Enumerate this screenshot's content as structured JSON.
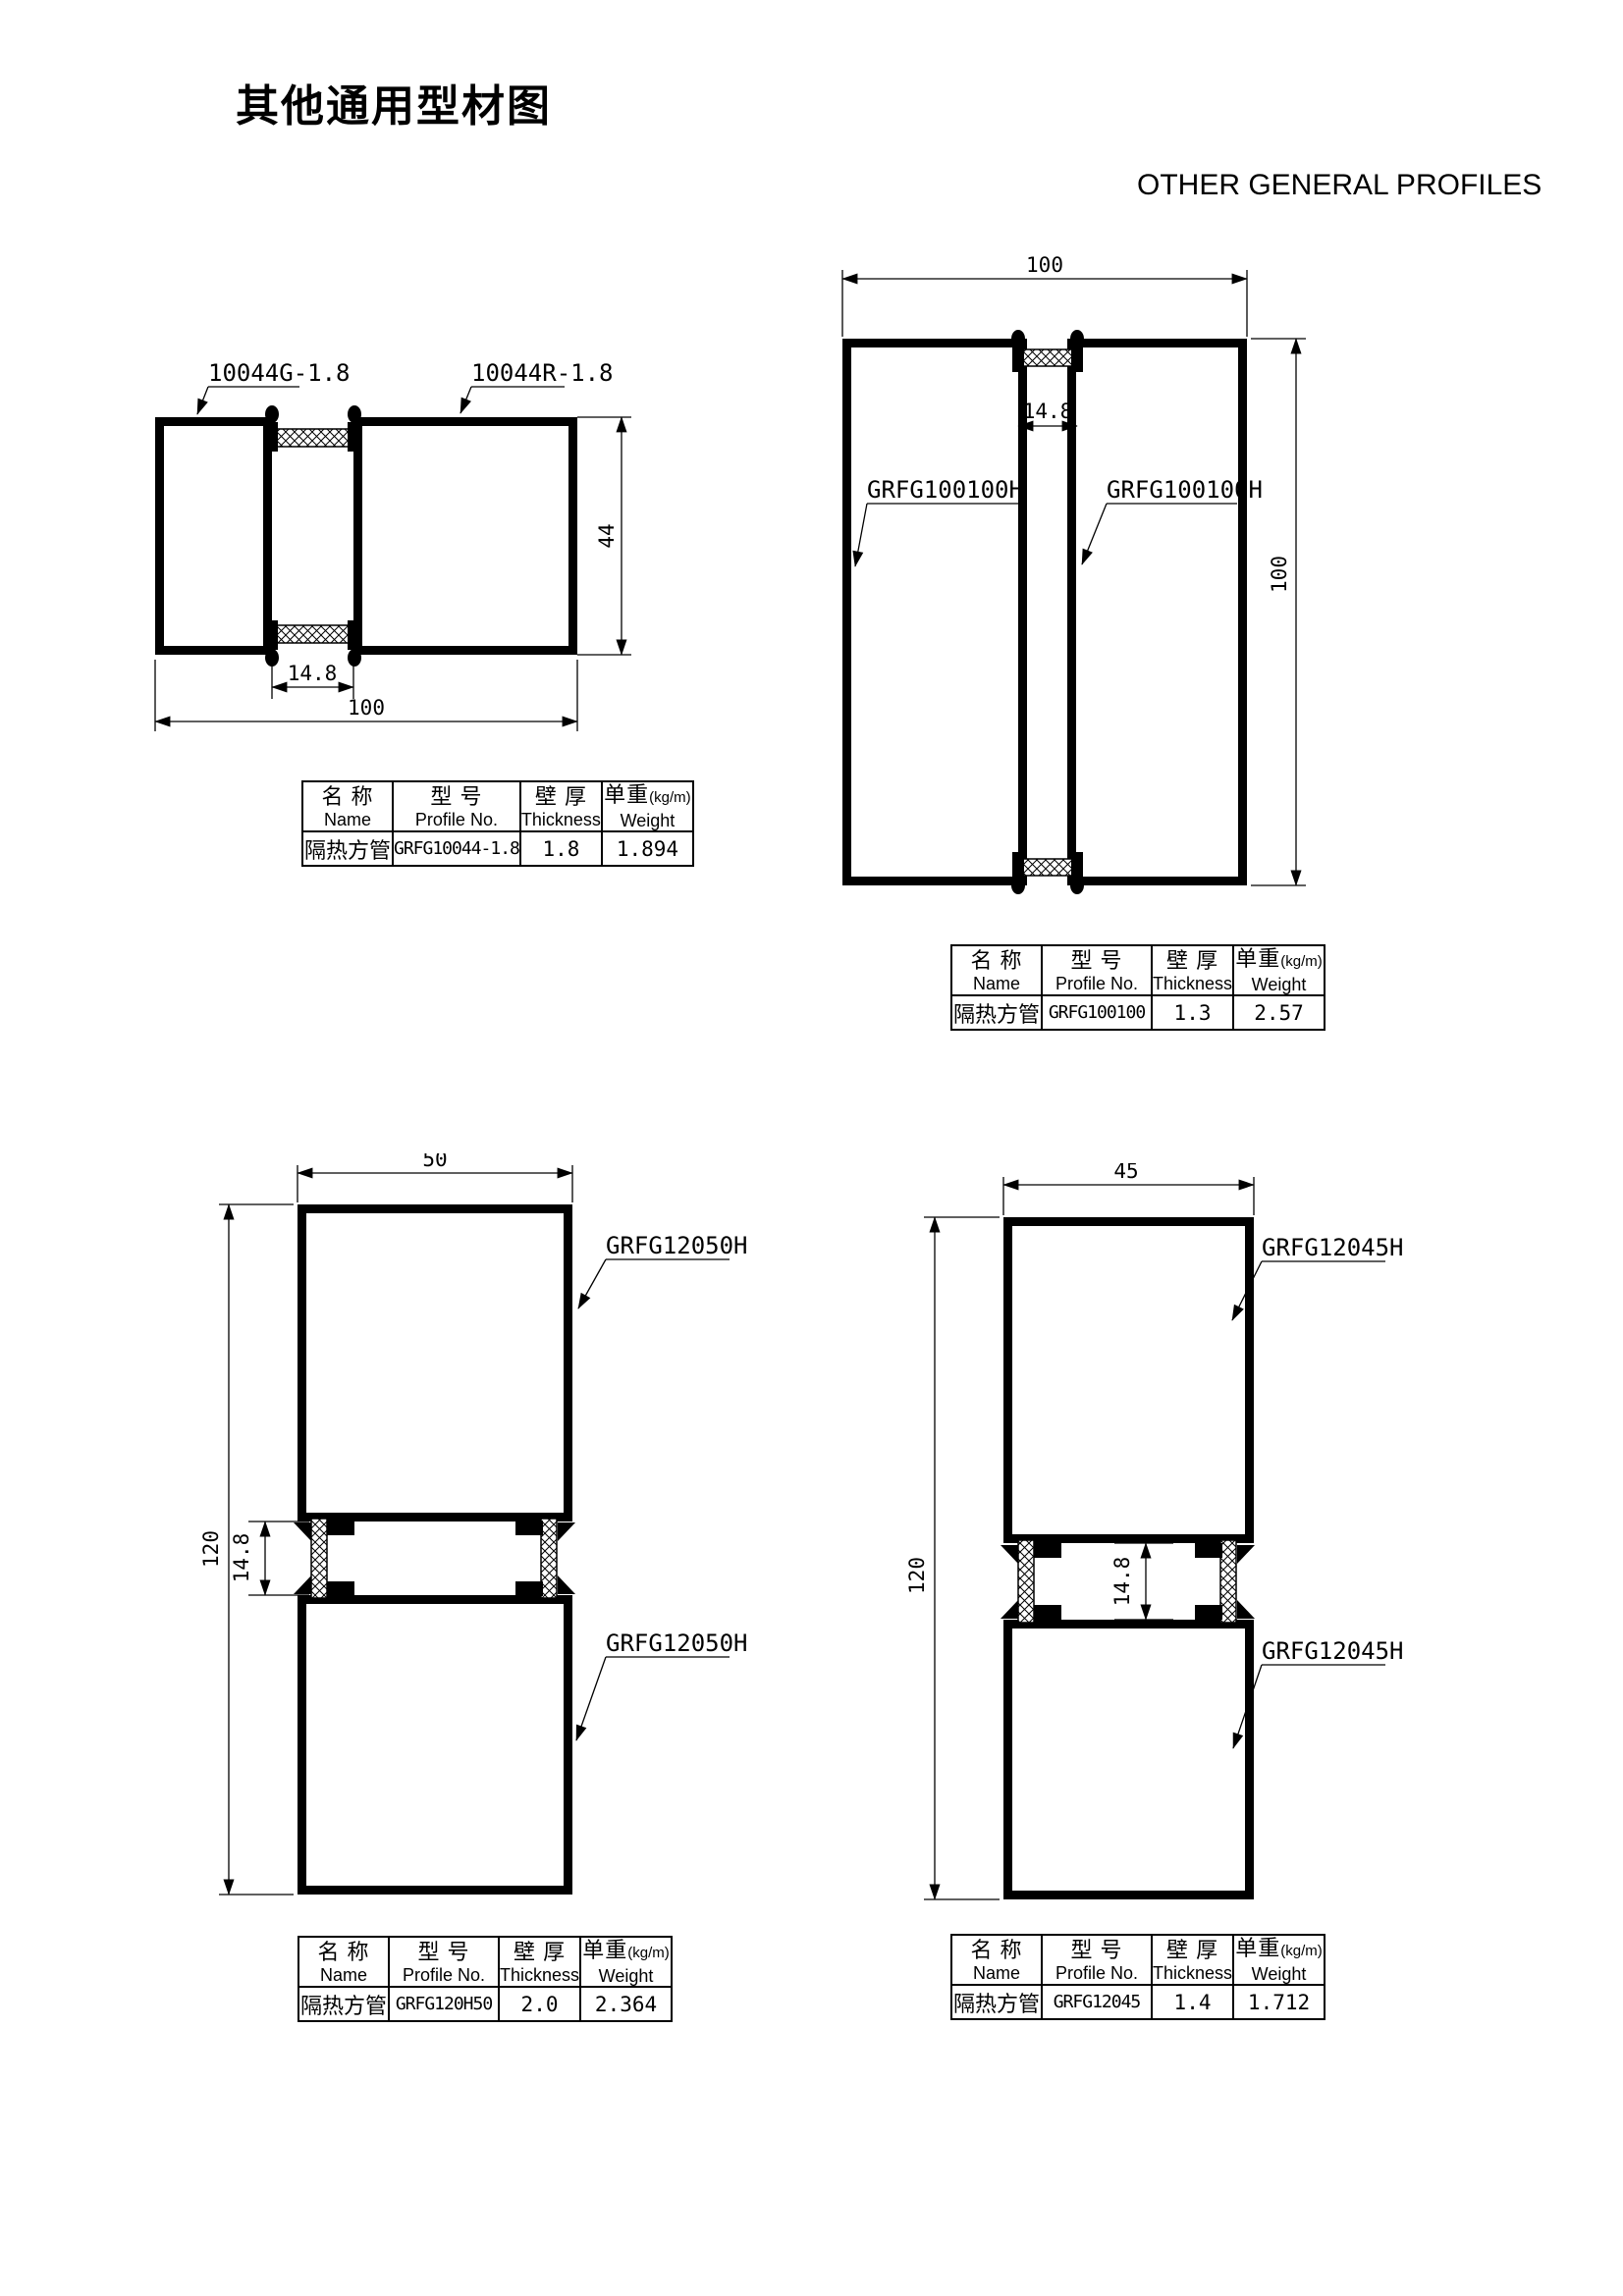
{
  "page": {
    "title": "其他通用型材图",
    "subtitle": "OTHER GENERAL PROFILES"
  },
  "table_headers": {
    "name_cn": "名 称",
    "name_en": "Name",
    "profile_cn": "型 号",
    "profile_en": "Profile No.",
    "thickness_cn": "壁 厚",
    "thickness_en": "Thickness",
    "weight_cn": "单重",
    "weight_unit": "(kg/m)",
    "weight_en": "Weight"
  },
  "drawings": [
    {
      "figure": "insulated-square-tube-100x44",
      "callouts": {
        "left": "10044G-1.8",
        "right": "10044R-1.8"
      },
      "dims": {
        "overall_width": "100",
        "overall_height": "44",
        "break_width": "14.8"
      },
      "table": {
        "name": "隔热方管",
        "profile_no": "GRFG10044-1.8",
        "thickness": "1.8",
        "weight": "1.894"
      }
    },
    {
      "figure": "insulated-square-tube-100x100",
      "callouts": {
        "left": "GRFG100100H",
        "right": "GRFG100100H"
      },
      "dims": {
        "overall_width": "100",
        "overall_height": "100",
        "break_width": "14.8"
      },
      "table": {
        "name": "隔热方管",
        "profile_no": "GRFG100100",
        "thickness": "1.3",
        "weight": "2.57"
      }
    },
    {
      "figure": "insulated-square-tube-120x50",
      "callouts": {
        "top": "GRFG12050H",
        "bottom": "GRFG12050H"
      },
      "dims": {
        "overall_width": "50",
        "overall_height": "120",
        "break_width": "14.8"
      },
      "table": {
        "name": "隔热方管",
        "profile_no": "GRFG120H50",
        "thickness": "2.0",
        "weight": "2.364"
      }
    },
    {
      "figure": "insulated-square-tube-120x45",
      "callouts": {
        "top": "GRFG12045H",
        "bottom": "GRFG12045H"
      },
      "dims": {
        "overall_width": "45",
        "overall_height": "120",
        "break_width": "14.8"
      },
      "table": {
        "name": "隔热方管",
        "profile_no": "GRFG12045",
        "thickness": "1.4",
        "weight": "1.712"
      }
    }
  ],
  "colors": {
    "line": "#000000",
    "background": "#ffffff"
  }
}
